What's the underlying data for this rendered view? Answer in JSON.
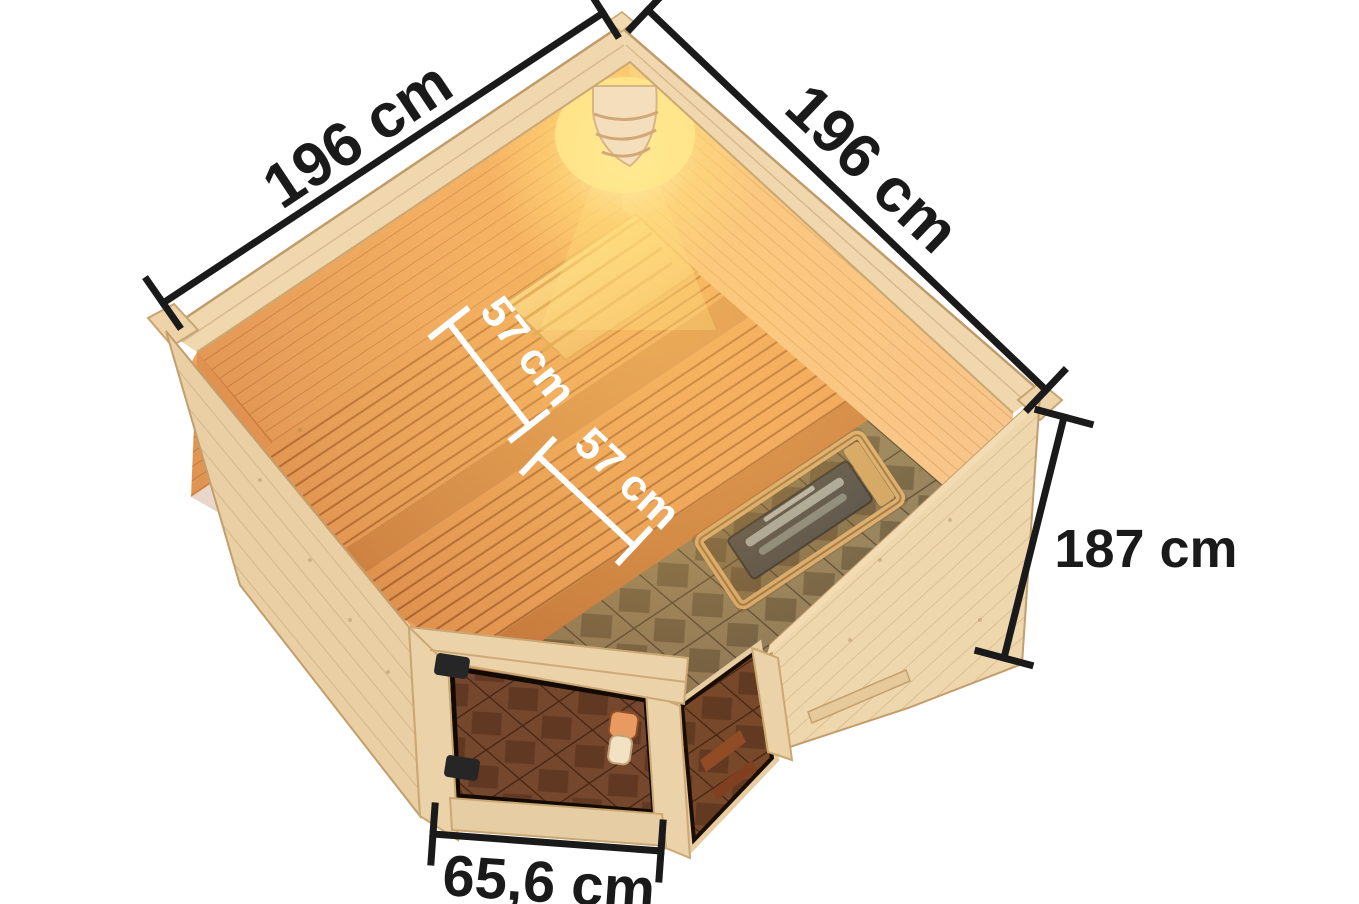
{
  "title": "Corner sauna dimension diagram (top view)",
  "canvas": {
    "width": 1359,
    "height": 904,
    "background": "#ffffff"
  },
  "labels": {
    "wall_left": "196 cm",
    "wall_right": "196 cm",
    "height": "187 cm",
    "bench_upper_depth": "57 cm",
    "bench_lower_depth": "57 cm",
    "door_width": "65,6 cm"
  },
  "colors": {
    "dimension_line": "#1a1a1a",
    "interior_dimension_line": "#ffffff",
    "wood_exterior": "#eacfa4",
    "wood_rim": "#f0d7ae",
    "wood_interior_wall": "#f4aa65",
    "bench_wood": "#f2a761",
    "lamp_glow": "#ffe08a",
    "floor_tile_base": "#8d7c5d",
    "floor_tile_diamond": "#6b5d45",
    "door_glass": "#5a3a26",
    "hinge": "#262626",
    "heater_body": "#46464a"
  }
}
